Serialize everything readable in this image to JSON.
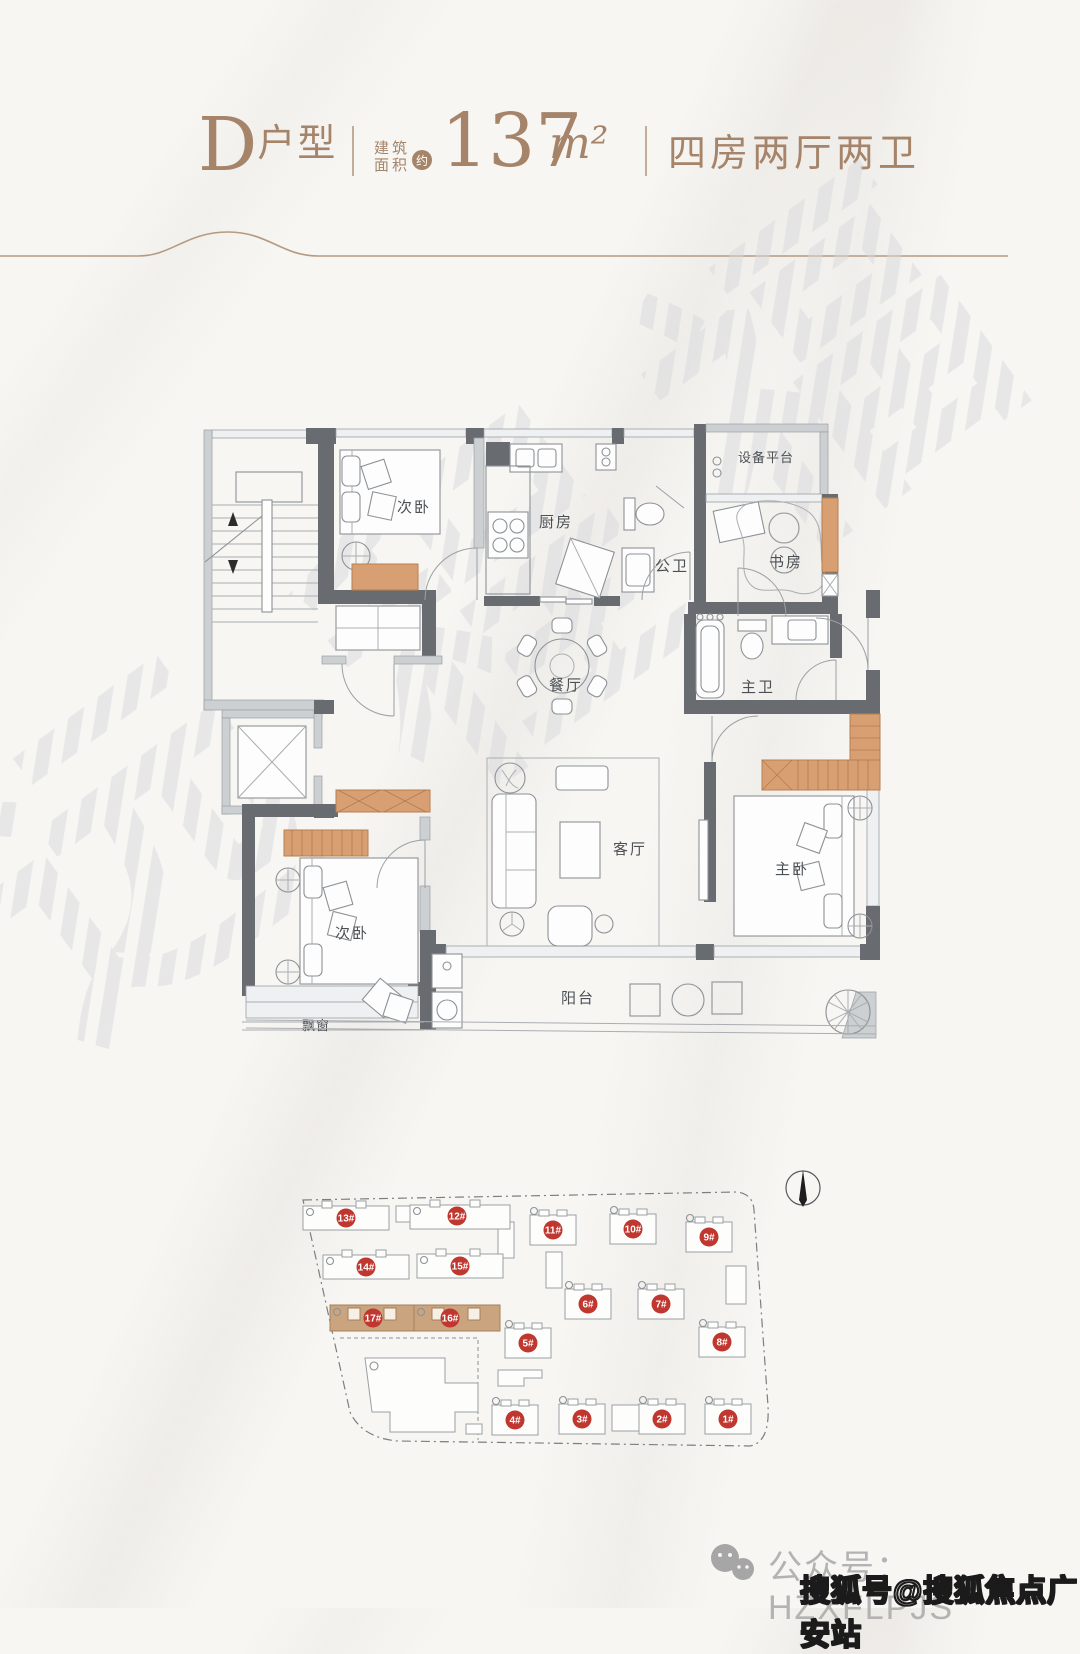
{
  "header": {
    "unit_label_letter": "D",
    "unit_label_suffix": "户型",
    "area_label_line1": "建筑",
    "area_label_line2": "面积",
    "area_approx": "约",
    "area_value": "137",
    "area_unit": "m²",
    "layout_label": "四房两厅两卫",
    "accent_color": "#a5846a"
  },
  "floor_plan": {
    "wall_color": "#686c70",
    "wardrobe_color": "#d89f72",
    "rooms": [
      {
        "id": "bedroom-top",
        "label": "次卧"
      },
      {
        "id": "kitchen",
        "label": "厨房"
      },
      {
        "id": "public-bath",
        "label": "公卫"
      },
      {
        "id": "equipment-platform",
        "label": "设备平台"
      },
      {
        "id": "study",
        "label": "书房"
      },
      {
        "id": "dining",
        "label": "餐厅"
      },
      {
        "id": "master-bath",
        "label": "主卫"
      },
      {
        "id": "living",
        "label": "客厅"
      },
      {
        "id": "master-bedroom",
        "label": "主卧"
      },
      {
        "id": "bedroom-bottom",
        "label": "次卧"
      },
      {
        "id": "bay-window",
        "label": "飘窗"
      },
      {
        "id": "balcony",
        "label": "阳台"
      }
    ]
  },
  "site_plan": {
    "badge_color": "#c0372f",
    "highlight_color": "#c9a47f",
    "highlighted": [
      "16#",
      "17#"
    ],
    "buildings": [
      {
        "no": "1#"
      },
      {
        "no": "2#"
      },
      {
        "no": "3#"
      },
      {
        "no": "4#"
      },
      {
        "no": "5#"
      },
      {
        "no": "6#"
      },
      {
        "no": "7#"
      },
      {
        "no": "8#"
      },
      {
        "no": "9#"
      },
      {
        "no": "10#"
      },
      {
        "no": "11#"
      },
      {
        "no": "12#"
      },
      {
        "no": "13#"
      },
      {
        "no": "14#"
      },
      {
        "no": "15#"
      },
      {
        "no": "16#"
      },
      {
        "no": "17#"
      }
    ]
  },
  "watermarks": {
    "diagonal": "远程福",
    "sohu": "搜狐号@搜狐焦点广安站"
  },
  "footer": {
    "wechat_label": "公众号：HZXFLPJS"
  }
}
